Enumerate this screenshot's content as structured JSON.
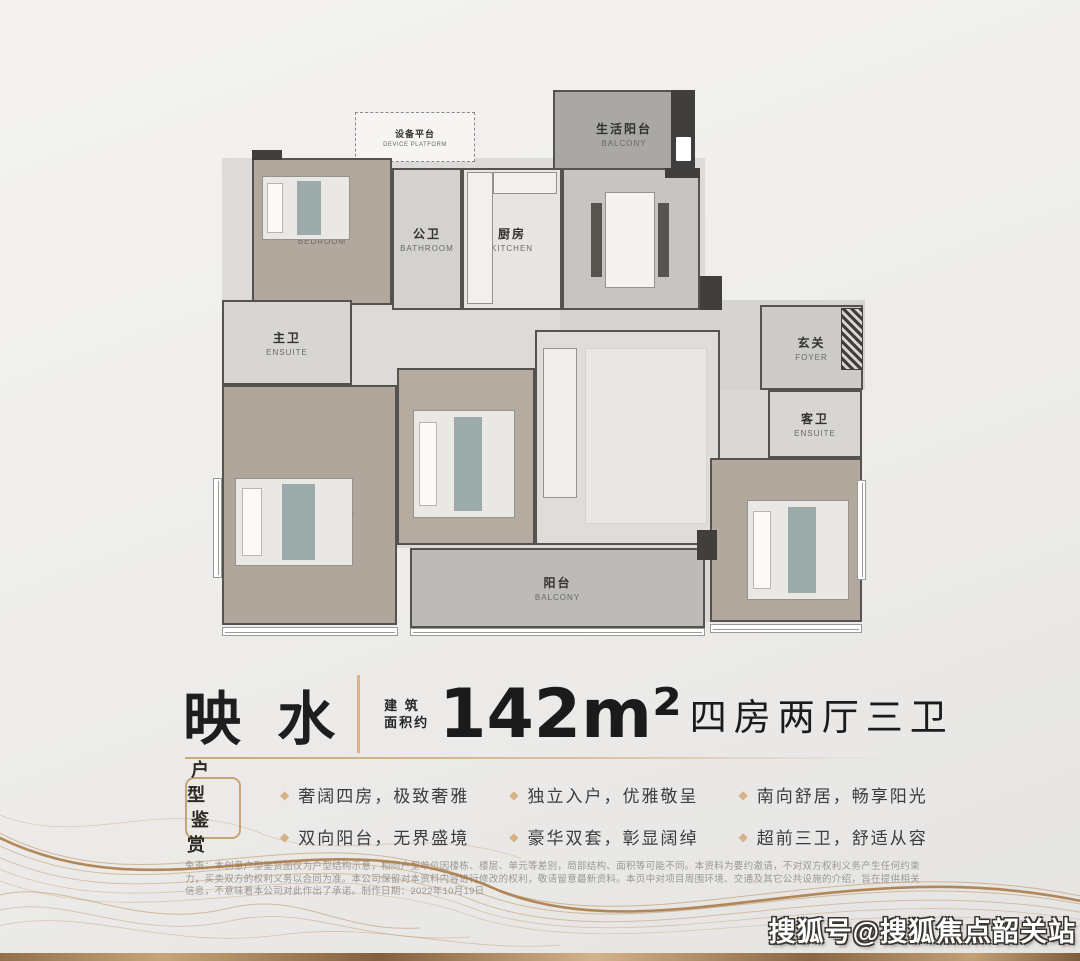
{
  "colors": {
    "accent": "#cfa873",
    "divider": "#dfb389",
    "wall": "#403f3d",
    "diamond": "#d6b285"
  },
  "icons": {
    "diamond": "◆"
  },
  "floorplan": {
    "bases": [
      {
        "name": "plan-base-core",
        "x": 17,
        "y": 78,
        "w": 483,
        "h": 390,
        "fill": "#dcdbd9"
      },
      {
        "name": "plan-base-foyer",
        "x": 355,
        "y": 220,
        "w": 305,
        "h": 90,
        "fill": "#d5d4d2"
      },
      {
        "name": "plan-base-east",
        "x": 500,
        "y": 310,
        "w": 157,
        "h": 232,
        "fill": "#d9d8d6"
      }
    ],
    "rooms": [
      {
        "name": "room-device-platform",
        "cn": "设备平台",
        "en": "DEVICE PLATFORM",
        "x": 150,
        "y": 32,
        "w": 120,
        "h": 50,
        "fill": "#f6f5f4",
        "cls": "sm outline"
      },
      {
        "name": "room-life-balcony",
        "cn": "生活阳台",
        "en": "BALCONY",
        "x": 348,
        "y": 10,
        "w": 142,
        "h": 88,
        "fill": "#a9a8a6"
      },
      {
        "name": "room-bedroom-northwest",
        "cn": "客卧",
        "en": "BEDROOM",
        "x": 47,
        "y": 78,
        "w": 140,
        "h": 147,
        "fill": "#b3a89e"
      },
      {
        "name": "room-public-bathroom",
        "cn": "公卫",
        "en": "BATHROOM",
        "x": 187,
        "y": 88,
        "w": 70,
        "h": 142,
        "fill": "#d3d2d0"
      },
      {
        "name": "room-kitchen",
        "cn": "厨房",
        "en": "KITCHEN",
        "x": 257,
        "y": 88,
        "w": 100,
        "h": 142,
        "fill": "#e7e5e3"
      },
      {
        "name": "room-dining",
        "cn": "餐厅",
        "en": "DINNING",
        "x": 357,
        "y": 88,
        "w": 138,
        "h": 142,
        "fill": "#c6c5c3"
      },
      {
        "name": "room-foyer",
        "cn": "玄关",
        "en": "FOYER",
        "x": 555,
        "y": 225,
        "w": 103,
        "h": 85,
        "fill": "#cccbc9"
      },
      {
        "name": "room-master-ensuite",
        "cn": "主卫",
        "en": "ENSUITE",
        "x": 17,
        "y": 220,
        "w": 130,
        "h": 85,
        "fill": "#d7d6d4"
      },
      {
        "name": "room-master-bedroom",
        "cn": "主卧",
        "en": "MASTER BEDROOM",
        "x": 17,
        "y": 305,
        "w": 175,
        "h": 240,
        "fill": "#b1a69b"
      },
      {
        "name": "room-bedroom-center",
        "cn": "客卧",
        "en": "BEDROOM",
        "x": 192,
        "y": 288,
        "w": 138,
        "h": 177,
        "fill": "#b6aba1"
      },
      {
        "name": "room-living",
        "cn": "客厅",
        "en": "LIVING",
        "x": 330,
        "y": 250,
        "w": 185,
        "h": 215,
        "fill": "#dedddb"
      },
      {
        "name": "room-guest-ensuite",
        "cn": "客卫",
        "en": "ENSUITE",
        "x": 563,
        "y": 310,
        "w": 94,
        "h": 68,
        "fill": "#d7d6d4"
      },
      {
        "name": "room-bedroom-east",
        "cn": "客卧",
        "en": "BEDROOM",
        "x": 505,
        "y": 378,
        "w": 152,
        "h": 164,
        "fill": "#b3a89e"
      },
      {
        "name": "room-balcony-south",
        "cn": "阳台",
        "en": "BALCONY",
        "x": 205,
        "y": 468,
        "w": 295,
        "h": 80,
        "fill": "#bcbbb9"
      }
    ],
    "walls": [
      {
        "name": "wall-balcony-column",
        "x": 466,
        "y": 10,
        "w": 24,
        "h": 88,
        "fill": "#403f3d"
      },
      {
        "name": "wall-entry-shaft",
        "x": 636,
        "y": 228,
        "w": 22,
        "h": 62,
        "cls": "hatched"
      },
      {
        "name": "wall-dining-foyer",
        "x": 495,
        "y": 196,
        "w": 22,
        "h": 34,
        "fill": "#403f3d"
      },
      {
        "name": "wall-balcony-east",
        "x": 492,
        "y": 450,
        "w": 20,
        "h": 30,
        "fill": "#403f3d"
      },
      {
        "name": "wall-plan-topleft",
        "x": 47,
        "y": 70,
        "w": 30,
        "h": 10,
        "fill": "#403f3d"
      },
      {
        "name": "wall-plan-topright",
        "x": 460,
        "y": 88,
        "w": 35,
        "h": 10,
        "fill": "#403f3d"
      }
    ],
    "furniture": [
      {
        "name": "bed-northwest",
        "cls": "bed",
        "x": 57,
        "y": 96,
        "w": 88,
        "h": 64,
        "fill": "#eae8e5"
      },
      {
        "name": "bed-master",
        "cls": "bed",
        "x": 30,
        "y": 398,
        "w": 118,
        "h": 88,
        "fill": "#eae8e5"
      },
      {
        "name": "bed-center",
        "cls": "bed",
        "x": 208,
        "y": 330,
        "w": 102,
        "h": 108,
        "fill": "#eae8e5"
      },
      {
        "name": "bed-east",
        "cls": "bed",
        "x": 542,
        "y": 420,
        "w": 102,
        "h": 100,
        "fill": "#eae8e5"
      },
      {
        "name": "living-rug",
        "cls": "rug",
        "x": 380,
        "y": 268,
        "w": 122,
        "h": 176,
        "fill": "#e9e7e4"
      },
      {
        "name": "dining-table",
        "cls": "tbl",
        "x": 400,
        "y": 112,
        "w": 50,
        "h": 96,
        "fill": "#f4f3f1"
      },
      {
        "name": "sofa",
        "cls": "sofa",
        "x": 338,
        "y": 268,
        "w": 34,
        "h": 150,
        "fill": "#f0efed"
      },
      {
        "name": "kitchen-counter",
        "x": 262,
        "y": 92,
        "w": 26,
        "h": 132,
        "fill": "#f1f0ee"
      },
      {
        "name": "kitchen-sink-counter",
        "x": 288,
        "y": 92,
        "w": 64,
        "h": 22,
        "fill": "#f1f0ee"
      },
      {
        "name": "water-heater",
        "cls": "appliance",
        "x": 470,
        "y": 56,
        "w": 17,
        "h": 26,
        "fill": "#ffffff"
      }
    ],
    "windows": [
      {
        "name": "window-master-south",
        "x": 17,
        "y": 547,
        "w": 176,
        "h": 9
      },
      {
        "name": "window-balcony-rail",
        "x": 205,
        "y": 548,
        "w": 295,
        "h": 8
      },
      {
        "name": "window-east-south",
        "x": 505,
        "y": 544,
        "w": 152,
        "h": 9
      },
      {
        "name": "window-master-west",
        "cls": "v",
        "x": 8,
        "y": 398,
        "w": 9,
        "h": 100
      },
      {
        "name": "window-east-east",
        "cls": "v",
        "x": 652,
        "y": 400,
        "w": 9,
        "h": 100
      }
    ]
  },
  "title": {
    "name": "映 水",
    "area_label_line1": "建 筑",
    "area_label_line2": "面积约",
    "area": "142m²",
    "layout": "四房两厅三卫"
  },
  "badge": {
    "line1": "户 型",
    "line2": "鉴 赏"
  },
  "features": [
    "奢阔四房，极致奢雅",
    "双向阳台，无界盛境",
    "独立入户，优雅敬呈",
    "豪华双套，彰显阔绰",
    "南向舒居，畅享阳光",
    "超前三卫，舒适从容"
  ],
  "disclaimer": {
    "text": "免责：本创意户型鉴赏图仅为户型结构示意，相同户型单位因楼栋、楼层、单元等差别，局部结构、面积等可能不同。本资料为要约邀请，不对双方权利义务产生任何约束力，买卖双方的权利义务以合同为准。本公司保留对本资料内容进行修改的权利，敬请留意最新资料。本页中对项目周围环境、交通及其它公共设施的介绍，旨在提供相关信息，不意味着本公司对此作出了承诺。制作日期：2022年10月19日"
  },
  "watermark": {
    "text": "搜狐号@搜狐焦点韶关站"
  }
}
